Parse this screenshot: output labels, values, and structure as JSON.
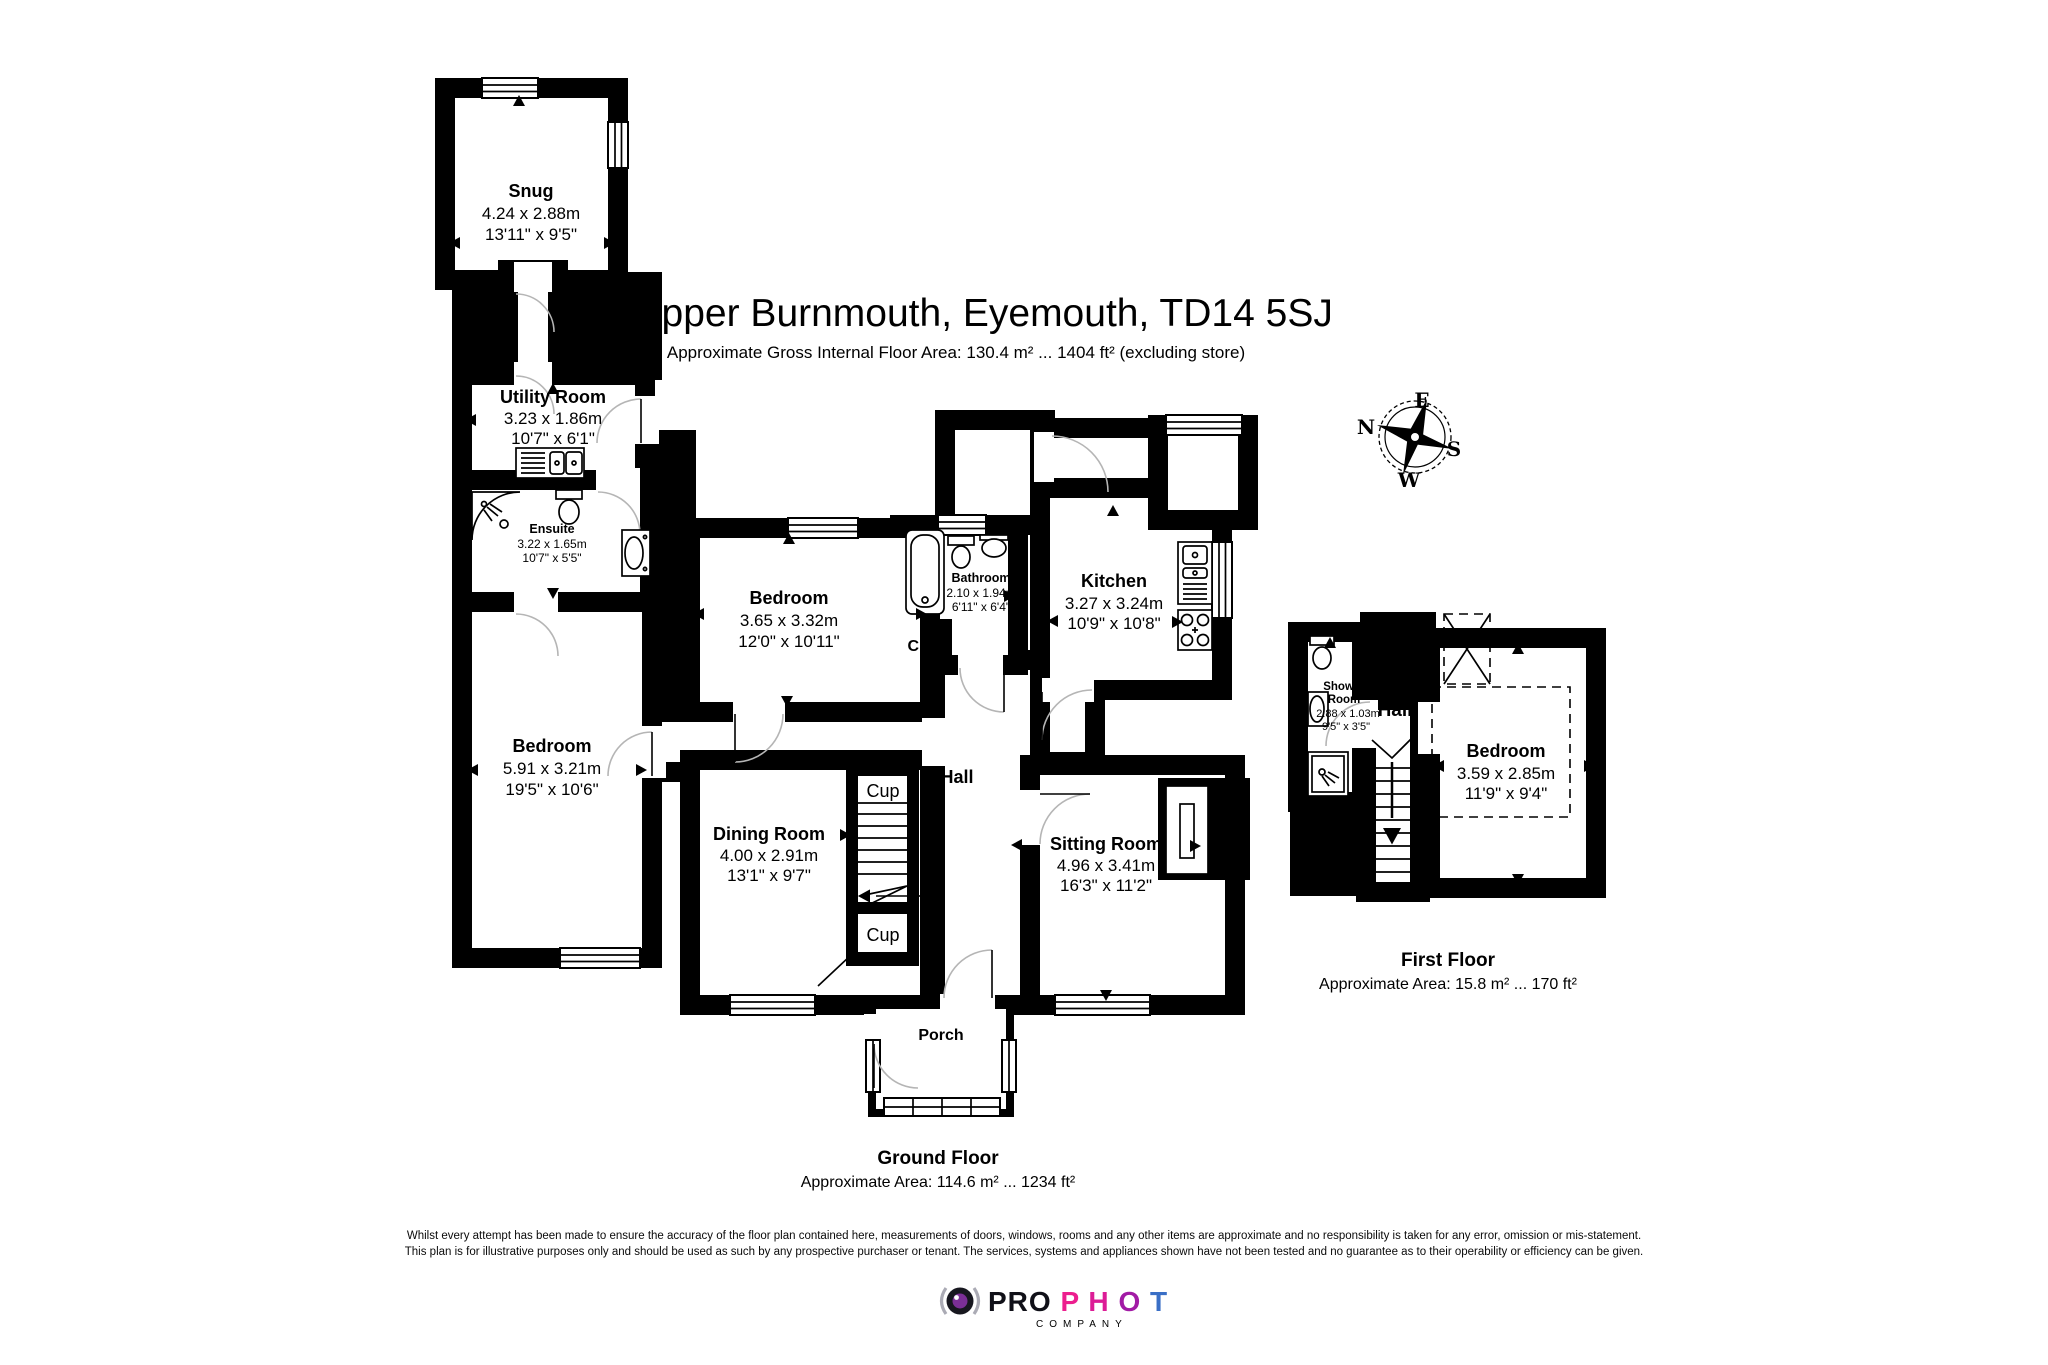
{
  "header": {
    "title": "13 Upper Burnmouth, Eyemouth, TD14 5SJ",
    "subtitle": "Approximate Gross Internal Floor Area: 130.4 m² ... 1404 ft² (excluding store)"
  },
  "ground_floor": {
    "floor_label": "Ground Floor",
    "floor_area": "Approximate Area: 114.6 m² ... 1234 ft²",
    "cup_label": "Cup",
    "hall_label": "Hall",
    "porch_label": "Porch",
    "rooms": {
      "snug": {
        "name": "Snug",
        "metric": "4.24 x 2.88m",
        "imperial": "13'11\" x 9'5\""
      },
      "utility": {
        "name": "Utility Room",
        "metric": "3.23 x 1.86m",
        "imperial": "10'7\" x 6'1\""
      },
      "ensuite": {
        "name": "Ensuite",
        "metric": "3.22 x 1.65m",
        "imperial": "10'7\" x 5'5\""
      },
      "bedroom_left": {
        "name": "Bedroom",
        "metric": "5.91 x 3.21m",
        "imperial": "19'5\" x 10'6\""
      },
      "bedroom_middle": {
        "name": "Bedroom",
        "metric": "3.65 x 3.32m",
        "imperial": "12'0\" x 10'11\""
      },
      "bathroom": {
        "name": "Bathroom",
        "metric": "2.10 x 1.94m",
        "imperial": "6'11\" x 6'4\""
      },
      "kitchen": {
        "name": "Kitchen",
        "metric": "3.27 x 3.24m",
        "imperial": "10'9\" x 10'8\""
      },
      "dining": {
        "name": "Dining Room",
        "metric": "4.00 x 2.91m",
        "imperial": "13'1\" x 9'7\""
      },
      "sitting": {
        "name": "Sitting Room",
        "metric": "4.96 x 3.41m",
        "imperial": "16'3\" x 11'2\""
      }
    }
  },
  "first_floor": {
    "floor_label": "First Floor",
    "floor_area": "Approximate Area: 15.8 m² ... 170 ft²",
    "hall_label": "Hall",
    "rooms": {
      "shower_room": {
        "name_line1": "Shower",
        "name_line2": "Room",
        "metric": "2.88 x 1.03m",
        "imperial": "9'5\" x 3'5\""
      },
      "bedroom": {
        "name": "Bedroom",
        "metric": "3.59 x 2.85m",
        "imperial": "11'9\" x 9'4\""
      }
    }
  },
  "compass": {
    "n": "N",
    "e": "E",
    "s": "S",
    "w": "W"
  },
  "disclaimer": {
    "line1": "Whilst every attempt has been made to ensure the accuracy of the floor plan contained here, measurements of doors, windows, rooms and any other items are approximate and no responsibility is taken for any error, omission or mis-statement.",
    "line2": "This plan is for illustrative purposes only and should be used as such by any prospective purchaser or tenant. The services, systems and appliances shown have not been tested and no guarantee as to their operability or efficiency can be given."
  },
  "logo": {
    "pro": "PRO",
    "pro_color": "#101018",
    "letters": [
      {
        "ch": "P",
        "color": "#EC1E8E"
      },
      {
        "ch": "H",
        "color": "#DC1C96"
      },
      {
        "ch": "O",
        "color": "#A21BA5"
      },
      {
        "ch": "T",
        "color": "#3A6FC6"
      },
      {
        "ch": "O",
        "color": "#29ABE2"
      }
    ],
    "company": "COMPANY",
    "company_color": "#A8A8B0"
  }
}
